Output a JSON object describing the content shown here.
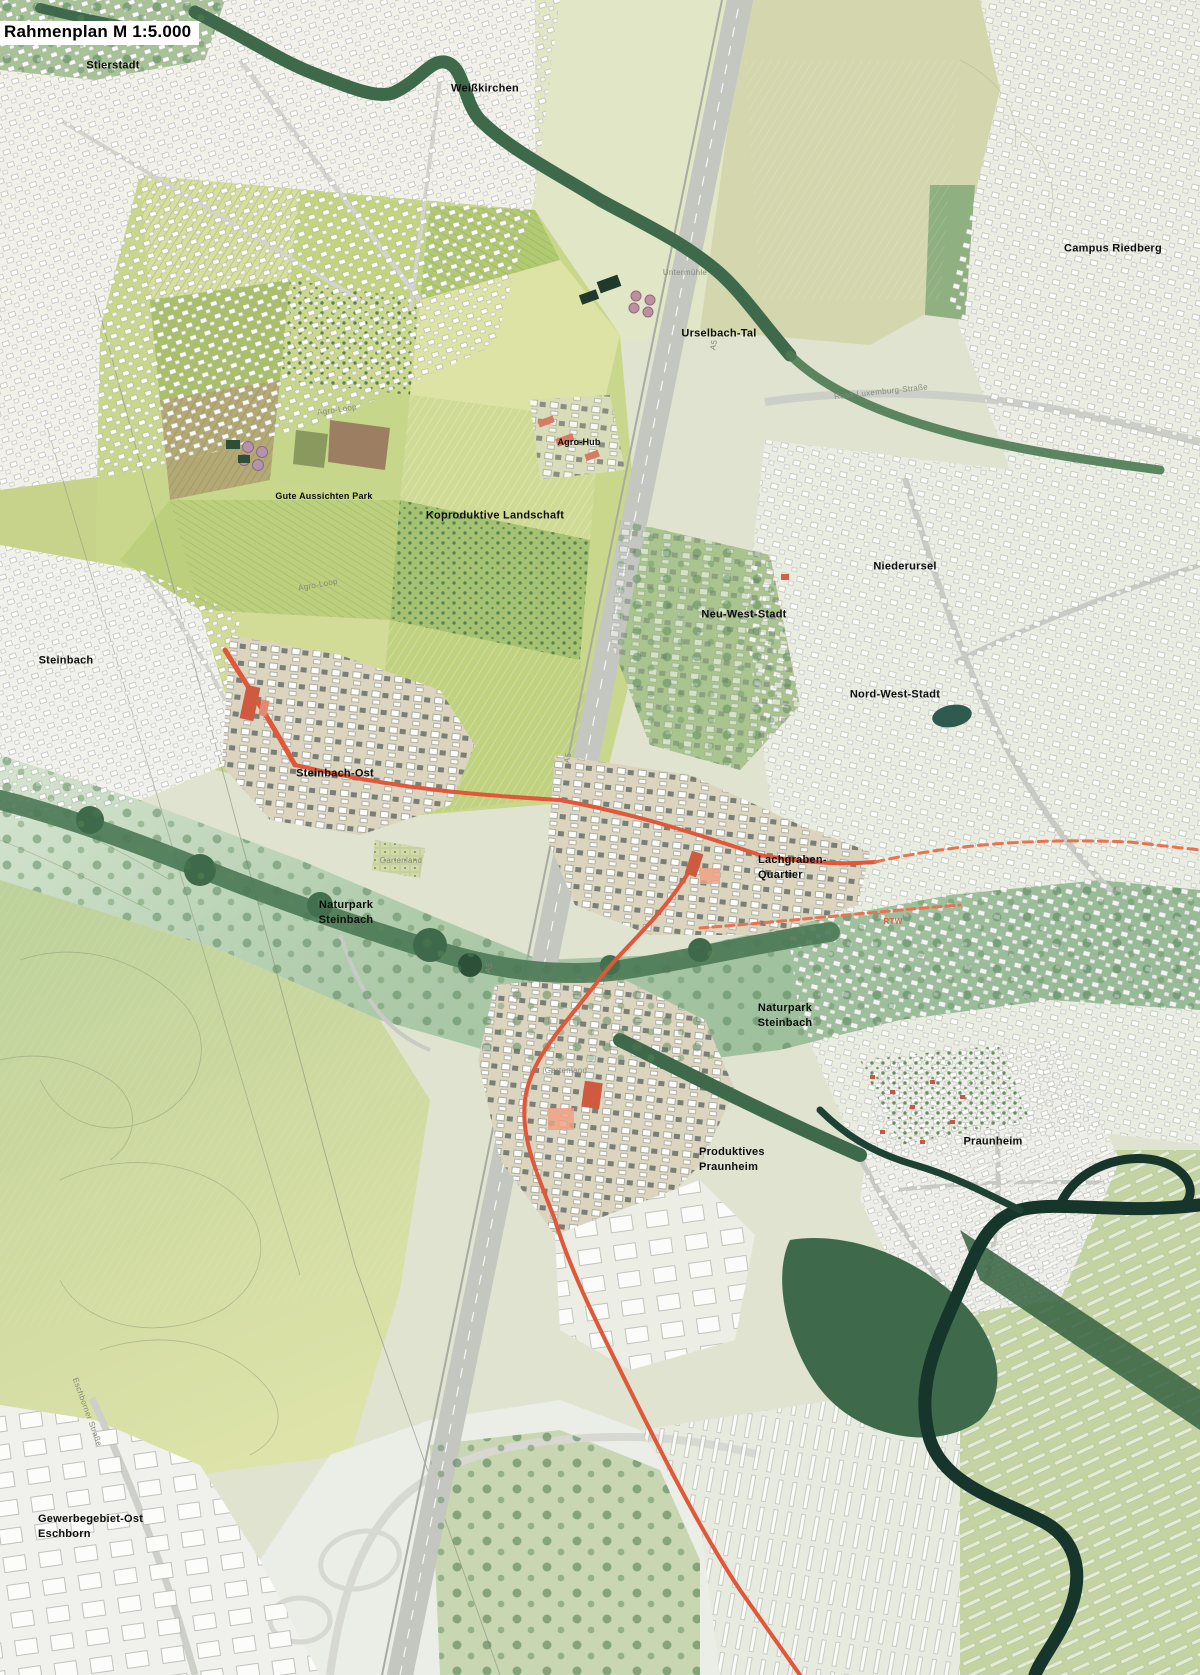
{
  "plan": {
    "title": "Rahmenplan M 1:5.000"
  },
  "palette": {
    "paper_urban": "#f1f1ea",
    "field_green": "#c9d78c",
    "forest_green": "#3e6a4b",
    "valley_green": "#97bb97",
    "river_teal": "#16352b",
    "highway_gray": "#c3c7bf",
    "accent_orange": "#e0573a",
    "quarter_red": "#d2604a",
    "label_black": "#0d0d0d",
    "minor_label_gray": "#85897b"
  },
  "labels": [
    {
      "id": "stierstadt",
      "kind": "place",
      "lines": [
        "Stierstadt"
      ],
      "x": 113,
      "y": 66
    },
    {
      "id": "weisskirchen",
      "kind": "place",
      "lines": [
        "Weißkirchen"
      ],
      "x": 485,
      "y": 89
    },
    {
      "id": "campus-riedberg",
      "kind": "place",
      "lines": [
        "Campus Riedberg"
      ],
      "x": 1113,
      "y": 249
    },
    {
      "id": "urselbach-tal",
      "kind": "place",
      "lines": [
        "Urselbach-Tal"
      ],
      "x": 719,
      "y": 334
    },
    {
      "id": "agro-hub",
      "kind": "place-sm",
      "lines": [
        "Agro-Hub"
      ],
      "x": 579,
      "y": 443
    },
    {
      "id": "gute-aussichten-park",
      "kind": "place-sm",
      "lines": [
        "Gute Aussichten Park"
      ],
      "x": 324,
      "y": 497
    },
    {
      "id": "koproduktive-landschaft",
      "kind": "place",
      "lines": [
        "Koproduktive Landschaft"
      ],
      "x": 495,
      "y": 516
    },
    {
      "id": "niederursel",
      "kind": "place",
      "lines": [
        "Niederursel"
      ],
      "x": 905,
      "y": 567
    },
    {
      "id": "neu-west-stadt",
      "kind": "place",
      "lines": [
        "Neu-West-Stadt"
      ],
      "x": 744,
      "y": 615
    },
    {
      "id": "nord-west-stadt",
      "kind": "place",
      "lines": [
        "Nord-West-Stadt"
      ],
      "x": 895,
      "y": 695
    },
    {
      "id": "steinbach",
      "kind": "place",
      "lines": [
        "Steinbach"
      ],
      "x": 66,
      "y": 661
    },
    {
      "id": "steinbach-ost",
      "kind": "place",
      "lines": [
        "Steinbach-Ost"
      ],
      "x": 335,
      "y": 774
    },
    {
      "id": "naturpark-steinbach-west",
      "kind": "place",
      "lines": [
        "Naturpark",
        "Steinbach"
      ],
      "x": 346,
      "y": 913
    },
    {
      "id": "lachgraben-quartier",
      "kind": "place",
      "lines": [
        "Lachgraben-",
        "Quartier"
      ],
      "x": 758,
      "y": 868,
      "align": "left"
    },
    {
      "id": "naturpark-steinbach-ost",
      "kind": "place",
      "lines": [
        "Naturpark",
        "Steinbach"
      ],
      "x": 785,
      "y": 1016
    },
    {
      "id": "produktives-praunheim",
      "kind": "place",
      "lines": [
        "Produktives",
        "Praunheim"
      ],
      "x": 699,
      "y": 1160,
      "align": "left"
    },
    {
      "id": "praunheim",
      "kind": "place",
      "lines": [
        "Praunheim"
      ],
      "x": 993,
      "y": 1142
    },
    {
      "id": "gewerbegebiet-ost-eschborn",
      "kind": "place",
      "lines": [
        "Gewerbegebiet-Ost",
        "Eschborn"
      ],
      "x": 38,
      "y": 1527,
      "align": "left"
    },
    {
      "id": "untermuehle",
      "kind": "minor",
      "lines": [
        "Untermühle"
      ],
      "x": 685,
      "y": 273
    },
    {
      "id": "agro-loop-nord",
      "kind": "minor",
      "lines": [
        "Agro-Loop"
      ],
      "x": 337,
      "y": 410,
      "rotate": -8
    },
    {
      "id": "agro-loop-mitte",
      "kind": "minor",
      "lines": [
        "Agro-Loop"
      ],
      "x": 318,
      "y": 585,
      "rotate": -10
    },
    {
      "id": "gartenland-west",
      "kind": "minor",
      "lines": [
        "Gartenland"
      ],
      "x": 401,
      "y": 861
    },
    {
      "id": "gartenland-sued",
      "kind": "minor",
      "lines": [
        "Gartenland"
      ],
      "x": 566,
      "y": 1071
    },
    {
      "id": "rosa-luxemburg-strasse",
      "kind": "minor",
      "lines": [
        "Rosa-Luxemburg-Straße"
      ],
      "x": 881,
      "y": 392,
      "rotate": -6
    },
    {
      "id": "eschborner-strasse",
      "kind": "minor",
      "lines": [
        "Eschborner Straße"
      ],
      "x": 87,
      "y": 1412,
      "rotate": 70
    },
    {
      "id": "rtw",
      "kind": "minor-accent",
      "lines": [
        "RTW"
      ],
      "x": 893,
      "y": 922
    },
    {
      "id": "a5-nord",
      "kind": "minor",
      "lines": [
        "A5"
      ],
      "x": 714,
      "y": 345,
      "rotate": -79
    },
    {
      "id": "a5-mitte",
      "kind": "minor",
      "lines": [
        "A5"
      ],
      "x": 568,
      "y": 758,
      "rotate": -79
    },
    {
      "id": "a5-sued",
      "kind": "minor",
      "lines": [
        "A5"
      ],
      "x": 489,
      "y": 968,
      "rotate": -79
    }
  ]
}
